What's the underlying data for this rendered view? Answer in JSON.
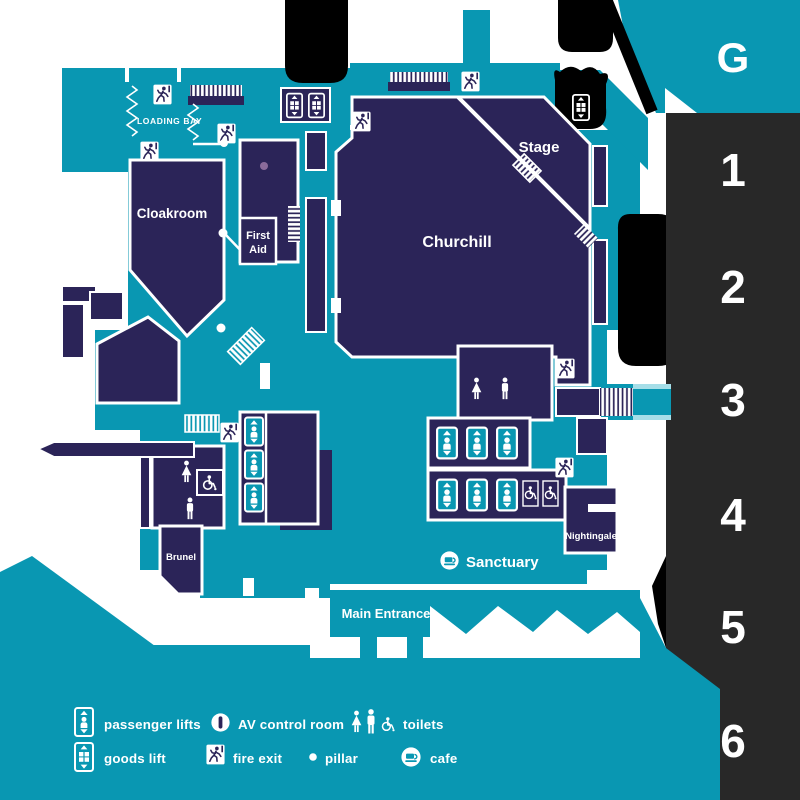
{
  "colors": {
    "floor_teal": "#0997B2",
    "room_navy": "#2B2458",
    "selector_dark": "#282828",
    "active_level_teal": "#0997B2",
    "light_strip": "#A6DEE8",
    "pillar_mauve": "#8A6B9B",
    "exterior_black": "#000000",
    "text_white": "#FFFFFF"
  },
  "floor_selector": {
    "active_level": "G",
    "levels": [
      {
        "label": "G"
      },
      {
        "label": "1"
      },
      {
        "label": "2"
      },
      {
        "label": "3"
      },
      {
        "label": "4"
      },
      {
        "label": "5"
      },
      {
        "label": "6"
      }
    ]
  },
  "map": {
    "rooms": {
      "churchill": "Churchill",
      "stage": "Stage",
      "cloakroom": "Cloakroom",
      "first_aid": [
        "First",
        "Aid"
      ],
      "brunel": "Brunel",
      "nightingale": "Nightingale"
    },
    "areas": {
      "loading_bay": "LOADING BAY",
      "sanctuary": "Sanctuary",
      "main_entrance": "Main Entrance"
    }
  },
  "legend": {
    "items": [
      {
        "icon": "passenger-lift-icon",
        "label": "passenger lifts"
      },
      {
        "icon": "av-control-room-icon",
        "label": "AV control room"
      },
      {
        "icon": "toilets-icon",
        "label": "toilets"
      },
      {
        "icon": "goods-lift-icon",
        "label": "goods lift"
      },
      {
        "icon": "fire-exit-icon",
        "label": "fire exit"
      },
      {
        "icon": "pillar-icon",
        "label": "pillar"
      },
      {
        "icon": "cafe-icon",
        "label": "cafe"
      }
    ]
  }
}
